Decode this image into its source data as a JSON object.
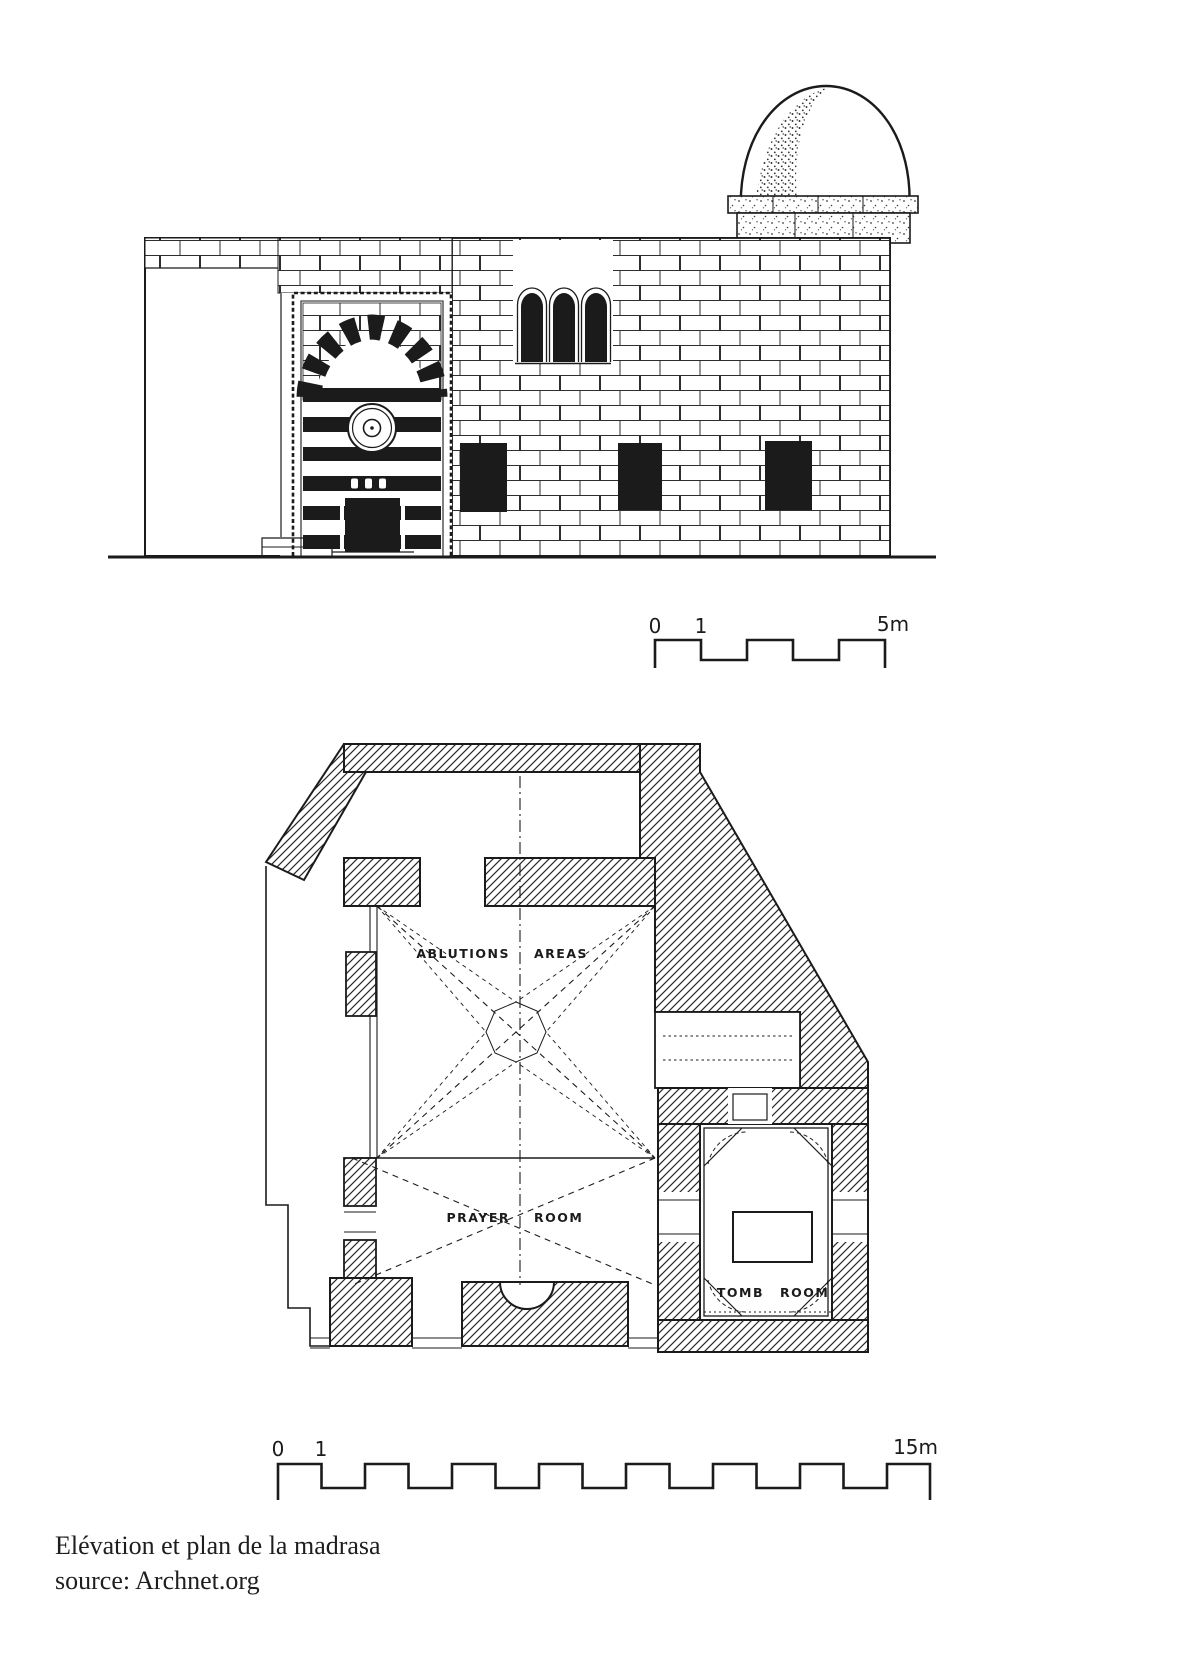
{
  "page": {
    "background": "#ffffff",
    "ink": "#1b1b1b"
  },
  "elevation": {
    "scale_bar": {
      "label_0": "0",
      "label_1": "1",
      "label_end": "5m"
    }
  },
  "plan": {
    "labels": {
      "ablutions_word1": "ABLUTIONS",
      "ablutions_word2": "AREAS",
      "prayer_word1": "PRAYER",
      "prayer_word2": "ROOM",
      "tomb_word1": "TOMB",
      "tomb_word2": "ROOM"
    },
    "scale_bar": {
      "label_0": "0",
      "label_1": "1",
      "label_end": "15m"
    }
  },
  "caption": {
    "line1": "Elévation et plan de la madrasa",
    "line2": "source: Archnet.org"
  }
}
